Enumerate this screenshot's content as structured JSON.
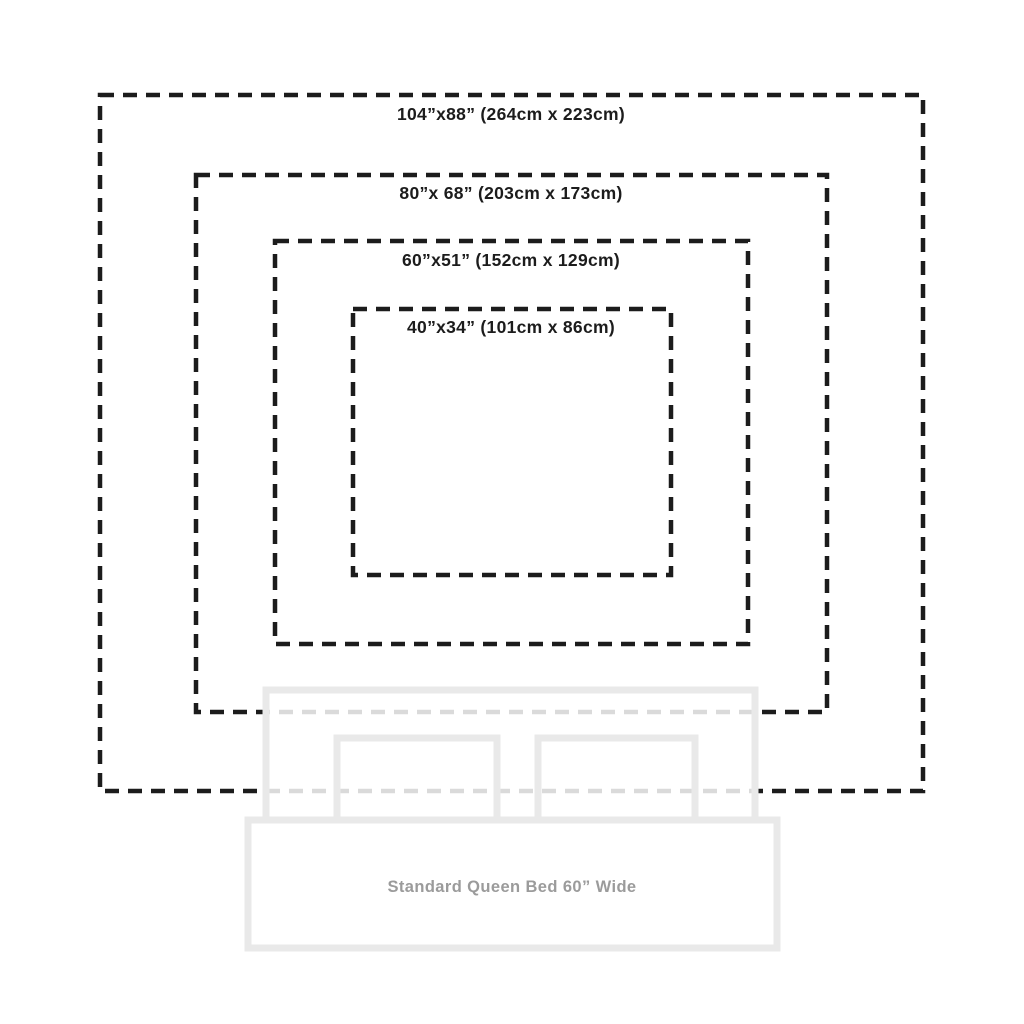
{
  "diagram": {
    "sizes": [
      {
        "id": "104x88",
        "label": "104”x88” (264cm x 223cm)"
      },
      {
        "id": "80x68",
        "label": "80”x 68” (203cm x 173cm)"
      },
      {
        "id": "60x51",
        "label": "60”x51” (152cm x 129cm)"
      },
      {
        "id": "40x34",
        "label": "40”x34” (101cm x 86cm)"
      }
    ],
    "bed": {
      "label": "Standard Queen Bed 60” Wide"
    }
  },
  "colors": {
    "background": "#ffffff",
    "dash_line": "#1c1c1c",
    "label_text": "#1c1c1c",
    "bed_outline": "#e9e9e9",
    "bed_label_text": "#9b9b9b"
  }
}
